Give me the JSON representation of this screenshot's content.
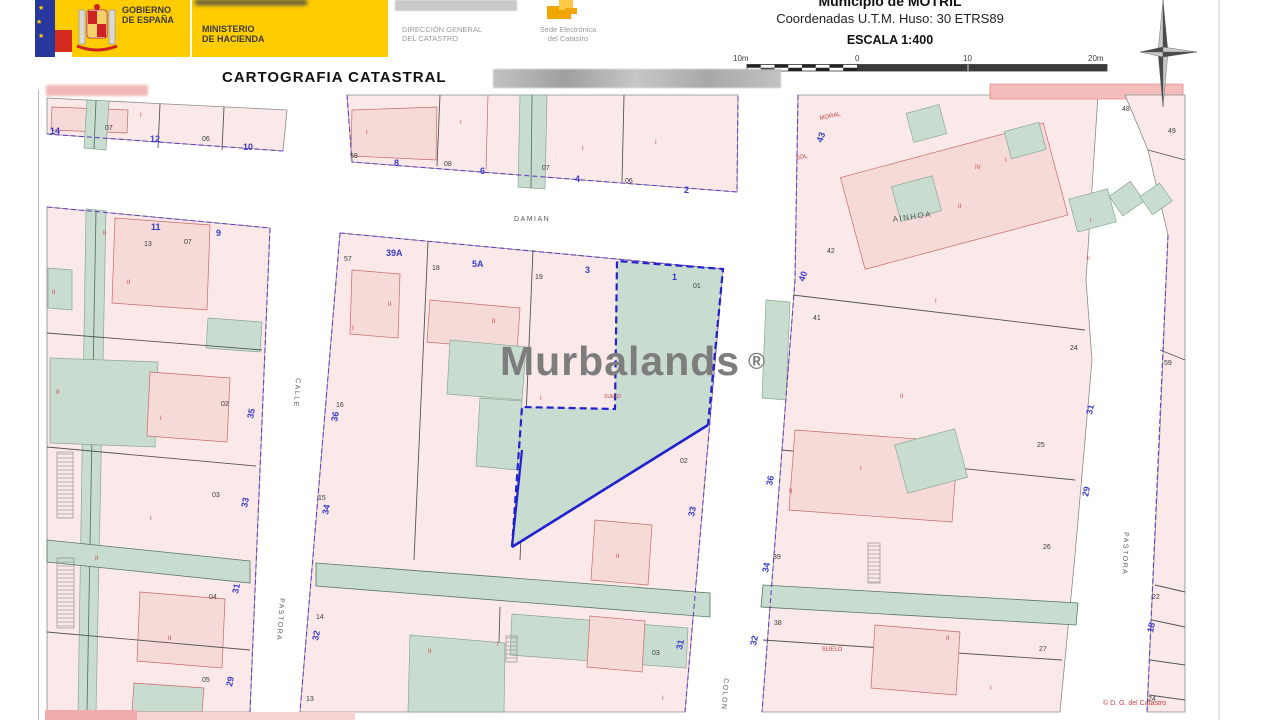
{
  "header": {
    "gobierno": {
      "line1": "GOBIERNO",
      "line2": "DE ESPAÑA"
    },
    "ministerio": {
      "line1": "MINISTERIO",
      "line2": "DE HACIENDA"
    },
    "direccion": {
      "line1": "DIRECCIÓN GENERAL",
      "line2": "DEL CATASTRO"
    },
    "sede": {
      "line1": "Sede Electrónica",
      "line2": "del Catastro"
    },
    "municipio": "Municipio de MOTRIL",
    "coordenadas": "Coordenadas U.T.M. Huso: 30 ETRS89",
    "escala": "ESCALA 1:400"
  },
  "title": "CARTOGRAFIA CATASTRAL",
  "watermark": {
    "text": "Murbalands",
    "symbol": "®"
  },
  "colors": {
    "parcel_pink": "#FAE9E8",
    "building_pink": "#F6DAD8",
    "courtyard_green": "#C9DCD0",
    "boundary_purple": "#6A3FC0",
    "highlight_blue": "#2222CC",
    "number_blue": "#3A3AC8",
    "detail_red": "#C94444",
    "brand_yellow": "#FFCC00"
  },
  "map": {
    "copyright": "© D. G. del Catastro",
    "scale_bar": {
      "labels": [
        "10m",
        "0",
        "10",
        "20m"
      ]
    },
    "labels": [
      {
        "t": "10m",
        "x": 733,
        "y": 61,
        "c": "blk",
        "s": 8,
        "n": "scale-label"
      },
      {
        "t": "0",
        "x": 855,
        "y": 61,
        "c": "blk",
        "s": 8,
        "n": "scale-label"
      },
      {
        "t": "10",
        "x": 963,
        "y": 61,
        "c": "blk",
        "s": 8,
        "n": "scale-label"
      },
      {
        "t": "20m",
        "x": 1088,
        "y": 61,
        "c": "blk",
        "s": 8,
        "n": "scale-label"
      },
      {
        "t": "14",
        "x": 50,
        "y": 134,
        "c": "blu",
        "s": 9
      },
      {
        "t": "07",
        "x": 105,
        "y": 130,
        "c": "blk",
        "s": 7
      },
      {
        "t": "12",
        "x": 150,
        "y": 142,
        "c": "blu",
        "s": 9
      },
      {
        "t": "06",
        "x": 202,
        "y": 141,
        "c": "blk",
        "s": 7
      },
      {
        "t": "10",
        "x": 243,
        "y": 150,
        "c": "blu",
        "s": 9
      },
      {
        "t": "I",
        "x": 140,
        "y": 117,
        "c": "red",
        "s": 6
      },
      {
        "t": "59",
        "x": 350,
        "y": 158,
        "c": "blk",
        "s": 7
      },
      {
        "t": "8",
        "x": 394,
        "y": 166,
        "c": "blu",
        "s": 9
      },
      {
        "t": "08",
        "x": 444,
        "y": 166,
        "c": "blk",
        "s": 7
      },
      {
        "t": "6",
        "x": 480,
        "y": 174,
        "c": "blu",
        "s": 9
      },
      {
        "t": "07",
        "x": 542,
        "y": 170,
        "c": "blk",
        "s": 7
      },
      {
        "t": "4",
        "x": 575,
        "y": 182,
        "c": "blu",
        "s": 9
      },
      {
        "t": "06",
        "x": 625,
        "y": 183,
        "c": "blk",
        "s": 7
      },
      {
        "t": "2",
        "x": 684,
        "y": 193,
        "c": "blu",
        "s": 9
      },
      {
        "t": "I",
        "x": 366,
        "y": 134,
        "c": "red",
        "s": 6
      },
      {
        "t": "I",
        "x": 460,
        "y": 124,
        "c": "red",
        "s": 6
      },
      {
        "t": "I",
        "x": 582,
        "y": 150,
        "c": "red",
        "s": 6
      },
      {
        "t": "I",
        "x": 655,
        "y": 144,
        "c": "red",
        "s": 6
      },
      {
        "t": "DAMIAN",
        "x": 514,
        "y": 221,
        "c": "st",
        "s": 7,
        "n": "street-label"
      },
      {
        "t": "11",
        "x": 151,
        "y": 230,
        "c": "blu",
        "s": 9
      },
      {
        "t": "13",
        "x": 144,
        "y": 246,
        "c": "blk",
        "s": 7
      },
      {
        "t": "07",
        "x": 184,
        "y": 244,
        "c": "blk",
        "s": 7
      },
      {
        "t": "9",
        "x": 216,
        "y": 236,
        "c": "blu",
        "s": 9
      },
      {
        "t": "II",
        "x": 103,
        "y": 235,
        "c": "red",
        "s": 6
      },
      {
        "t": "II",
        "x": 127,
        "y": 284,
        "c": "red",
        "s": 6
      },
      {
        "t": "II",
        "x": 52,
        "y": 294,
        "c": "red",
        "s": 6
      },
      {
        "t": "II",
        "x": 56,
        "y": 394,
        "c": "red",
        "s": 6
      },
      {
        "t": "I",
        "x": 160,
        "y": 420,
        "c": "red",
        "s": 6
      },
      {
        "t": "I",
        "x": 150,
        "y": 520,
        "c": "red",
        "s": 6
      },
      {
        "t": "II",
        "x": 168,
        "y": 640,
        "c": "red",
        "s": 6
      },
      {
        "t": "II",
        "x": 95,
        "y": 560,
        "c": "red",
        "s": 6
      },
      {
        "t": "02",
        "x": 221,
        "y": 406,
        "c": "blk",
        "s": 7
      },
      {
        "t": "03",
        "x": 212,
        "y": 497,
        "c": "blk",
        "s": 7
      },
      {
        "t": "04",
        "x": 209,
        "y": 599,
        "c": "blk",
        "s": 7
      },
      {
        "t": "05",
        "x": 202,
        "y": 682,
        "c": "blk",
        "s": 7
      },
      {
        "t": "35",
        "x": 253,
        "y": 419,
        "c": "blu",
        "s": 9,
        "r": -78
      },
      {
        "t": "33",
        "x": 247,
        "y": 508,
        "c": "blu",
        "s": 9,
        "r": -78
      },
      {
        "t": "31",
        "x": 238,
        "y": 594,
        "c": "blu",
        "s": 9,
        "r": -78
      },
      {
        "t": "29",
        "x": 232,
        "y": 687,
        "c": "blu",
        "s": 9,
        "r": -78
      },
      {
        "t": "CALLE",
        "x": 296,
        "y": 378,
        "c": "st",
        "s": 7,
        "r": 94,
        "n": "street-label"
      },
      {
        "t": "PASTORA",
        "x": 280,
        "y": 598,
        "c": "st",
        "s": 7,
        "r": 94,
        "n": "street-label"
      },
      {
        "t": "57",
        "x": 344,
        "y": 261,
        "c": "blk",
        "s": 7
      },
      {
        "t": "39A",
        "x": 386,
        "y": 256,
        "c": "blu",
        "s": 9
      },
      {
        "t": "18",
        "x": 432,
        "y": 270,
        "c": "blk",
        "s": 7
      },
      {
        "t": "5A",
        "x": 472,
        "y": 267,
        "c": "blu",
        "s": 9
      },
      {
        "t": "19",
        "x": 535,
        "y": 279,
        "c": "blk",
        "s": 7
      },
      {
        "t": "3",
        "x": 585,
        "y": 273,
        "c": "blu",
        "s": 9
      },
      {
        "t": "1",
        "x": 672,
        "y": 280,
        "c": "blu",
        "s": 9
      },
      {
        "t": "01",
        "x": 693,
        "y": 288,
        "c": "blk",
        "s": 7
      },
      {
        "t": "II",
        "x": 388,
        "y": 306,
        "c": "red",
        "s": 6
      },
      {
        "t": "II",
        "x": 492,
        "y": 323,
        "c": "red",
        "s": 6
      },
      {
        "t": "I",
        "x": 352,
        "y": 330,
        "c": "red",
        "s": 6
      },
      {
        "t": "I",
        "x": 540,
        "y": 400,
        "c": "red",
        "s": 6
      },
      {
        "t": "SUELO",
        "x": 604,
        "y": 398,
        "c": "red",
        "s": 5
      },
      {
        "t": "16",
        "x": 336,
        "y": 407,
        "c": "blk",
        "s": 7
      },
      {
        "t": "15",
        "x": 318,
        "y": 500,
        "c": "blk",
        "s": 7
      },
      {
        "t": "14",
        "x": 316,
        "y": 619,
        "c": "blk",
        "s": 7
      },
      {
        "t": "13",
        "x": 306,
        "y": 701,
        "c": "blk",
        "s": 7
      },
      {
        "t": "36",
        "x": 337,
        "y": 422,
        "c": "blu",
        "s": 9,
        "r": -78
      },
      {
        "t": "34",
        "x": 328,
        "y": 515,
        "c": "blu",
        "s": 9,
        "r": -78
      },
      {
        "t": "32",
        "x": 318,
        "y": 641,
        "c": "blu",
        "s": 9,
        "r": -78
      },
      {
        "t": "II",
        "x": 616,
        "y": 558,
        "c": "red",
        "s": 6
      },
      {
        "t": "I",
        "x": 497,
        "y": 646,
        "c": "red",
        "s": 6
      },
      {
        "t": "II",
        "x": 428,
        "y": 653,
        "c": "red",
        "s": 6
      },
      {
        "t": "02",
        "x": 680,
        "y": 463,
        "c": "blk",
        "s": 7
      },
      {
        "t": "03",
        "x": 652,
        "y": 655,
        "c": "blk",
        "s": 7
      },
      {
        "t": "I",
        "x": 662,
        "y": 700,
        "c": "red",
        "s": 6
      },
      {
        "t": "COLON",
        "x": 724,
        "y": 678,
        "c": "st",
        "s": 7,
        "r": 94,
        "n": "street-label"
      },
      {
        "t": "33",
        "x": 694,
        "y": 517,
        "c": "blu",
        "s": 9,
        "r": -78
      },
      {
        "t": "31",
        "x": 682,
        "y": 650,
        "c": "blu",
        "s": 9,
        "r": -78
      },
      {
        "t": "36",
        "x": 772,
        "y": 486,
        "c": "blu",
        "s": 9,
        "r": -78
      },
      {
        "t": "34",
        "x": 768,
        "y": 573,
        "c": "blu",
        "s": 9,
        "r": -78
      },
      {
        "t": "32",
        "x": 756,
        "y": 646,
        "c": "blu",
        "s": 9,
        "r": -78
      },
      {
        "t": "AINHOA",
        "x": 893,
        "y": 222,
        "c": "st",
        "s": 8,
        "r": -8,
        "n": "street-label"
      },
      {
        "t": "MORAL",
        "x": 820,
        "y": 120,
        "c": "rst",
        "s": 6,
        "r": -12
      },
      {
        "t": "SOL",
        "x": 796,
        "y": 160,
        "c": "rst",
        "s": 6,
        "r": -12
      },
      {
        "t": "43",
        "x": 822,
        "y": 143,
        "c": "blu",
        "s": 9,
        "r": -70
      },
      {
        "t": "42",
        "x": 827,
        "y": 253,
        "c": "blk",
        "s": 7
      },
      {
        "t": "40",
        "x": 804,
        "y": 282,
        "c": "blu",
        "s": 9,
        "r": -70
      },
      {
        "t": "41",
        "x": 813,
        "y": 320,
        "c": "blk",
        "s": 7
      },
      {
        "t": "IV",
        "x": 975,
        "y": 169,
        "c": "red",
        "s": 6
      },
      {
        "t": "II",
        "x": 958,
        "y": 208,
        "c": "red",
        "s": 6
      },
      {
        "t": "I",
        "x": 935,
        "y": 303,
        "c": "red",
        "s": 6
      },
      {
        "t": "I",
        "x": 1005,
        "y": 162,
        "c": "red",
        "s": 6
      },
      {
        "t": "24",
        "x": 1070,
        "y": 350,
        "c": "blk",
        "s": 7
      },
      {
        "t": "25",
        "x": 1037,
        "y": 447,
        "c": "blk",
        "s": 7
      },
      {
        "t": "26",
        "x": 1043,
        "y": 549,
        "c": "blk",
        "s": 7
      },
      {
        "t": "27",
        "x": 1039,
        "y": 651,
        "c": "blk",
        "s": 7
      },
      {
        "t": "39",
        "x": 773,
        "y": 559,
        "c": "blk",
        "s": 7
      },
      {
        "t": "38",
        "x": 774,
        "y": 625,
        "c": "blk",
        "s": 7
      },
      {
        "t": "SUELO",
        "x": 822,
        "y": 651,
        "c": "red",
        "s": 6
      },
      {
        "t": "II",
        "x": 789,
        "y": 493,
        "c": "red",
        "s": 6
      },
      {
        "t": "II",
        "x": 900,
        "y": 398,
        "c": "red",
        "s": 6
      },
      {
        "t": "I",
        "x": 860,
        "y": 470,
        "c": "red",
        "s": 6
      },
      {
        "t": "II",
        "x": 946,
        "y": 640,
        "c": "red",
        "s": 6
      },
      {
        "t": "I",
        "x": 990,
        "y": 690,
        "c": "red",
        "s": 6
      },
      {
        "t": "PASTORA",
        "x": 1124,
        "y": 532,
        "c": "st",
        "s": 7,
        "r": 92,
        "n": "street-label"
      },
      {
        "t": "31",
        "x": 1092,
        "y": 415,
        "c": "blu",
        "s": 9,
        "r": -78
      },
      {
        "t": "29",
        "x": 1088,
        "y": 497,
        "c": "blu",
        "s": 9,
        "r": -78
      },
      {
        "t": "I",
        "x": 1090,
        "y": 222,
        "c": "red",
        "s": 5
      },
      {
        "t": "II",
        "x": 1087,
        "y": 260,
        "c": "red",
        "s": 5
      },
      {
        "t": "48",
        "x": 1122,
        "y": 111,
        "c": "blk",
        "s": 7
      },
      {
        "t": "49",
        "x": 1168,
        "y": 133,
        "c": "blk",
        "s": 7
      },
      {
        "t": "59",
        "x": 1164,
        "y": 365,
        "c": "blk",
        "s": 7
      },
      {
        "t": "22",
        "x": 1152,
        "y": 599,
        "c": "blk",
        "s": 7
      },
      {
        "t": "18",
        "x": 1153,
        "y": 633,
        "c": "blu",
        "s": 9,
        "r": -78
      },
      {
        "t": "24",
        "x": 1148,
        "y": 701,
        "c": "blk",
        "s": 7
      },
      {
        "t": "© D. G. del Catastro",
        "x": 1103,
        "y": 705,
        "c": "rst",
        "s": 7,
        "n": "copyright"
      }
    ]
  }
}
